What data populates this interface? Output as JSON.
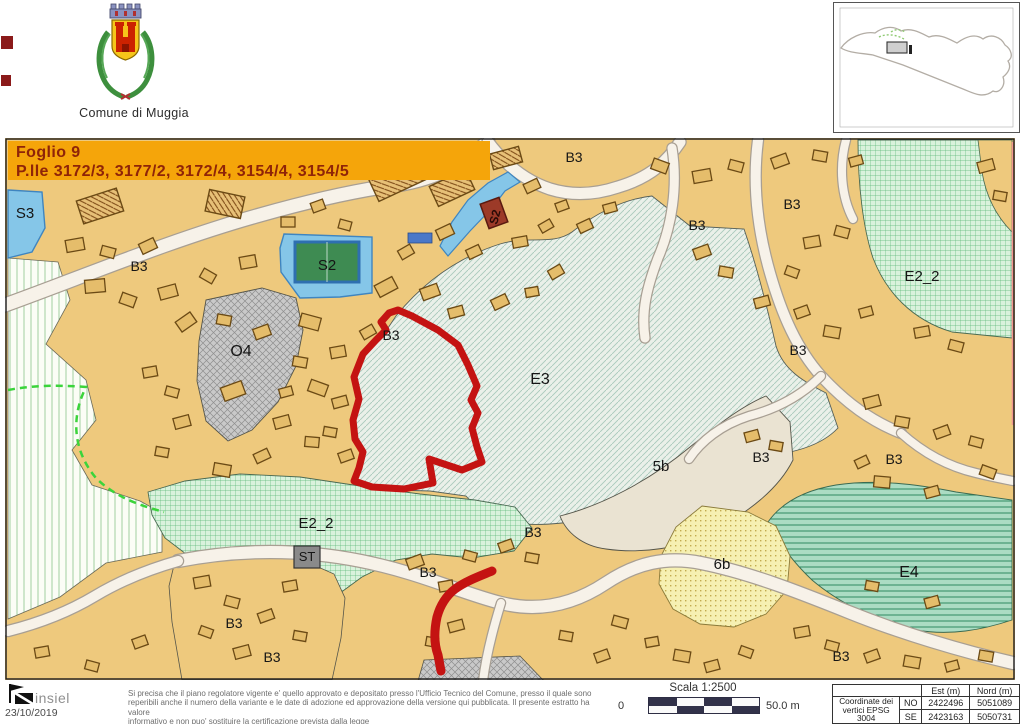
{
  "header": {
    "municipality": "Comune di Muggia"
  },
  "map": {
    "title_line1": "Foglio 9",
    "title_line2": "P.lle 3172/3, 3177/2, 3172/4, 3154/4, 3154/5",
    "building_label": "S2",
    "labels": [
      {
        "text": "S3",
        "x": 25,
        "y": 218,
        "size": 15
      },
      {
        "text": "B3",
        "x": 139,
        "y": 271,
        "size": 14
      },
      {
        "text": "S2",
        "x": 327,
        "y": 270,
        "size": 15
      },
      {
        "text": "B3",
        "x": 574,
        "y": 162,
        "size": 14
      },
      {
        "text": "B3",
        "x": 697,
        "y": 230,
        "size": 14
      },
      {
        "text": "B3",
        "x": 792,
        "y": 209,
        "size": 14
      },
      {
        "text": "E2_2",
        "x": 922,
        "y": 281,
        "size": 15
      },
      {
        "text": "B3",
        "x": 391,
        "y": 340,
        "size": 14
      },
      {
        "text": "O4",
        "x": 241,
        "y": 356,
        "size": 16
      },
      {
        "text": "E3",
        "x": 540,
        "y": 384,
        "size": 16
      },
      {
        "text": "B3",
        "x": 798,
        "y": 355,
        "size": 14
      },
      {
        "text": "B3",
        "x": 761,
        "y": 462,
        "size": 14
      },
      {
        "text": "5b",
        "x": 661,
        "y": 471,
        "size": 15
      },
      {
        "text": "B3",
        "x": 894,
        "y": 464,
        "size": 14
      },
      {
        "text": "E2_2",
        "x": 316,
        "y": 528,
        "size": 15
      },
      {
        "text": "ST",
        "x": 307,
        "y": 561,
        "size": 13
      },
      {
        "text": "B3",
        "x": 533,
        "y": 537,
        "size": 14
      },
      {
        "text": "B3",
        "x": 428,
        "y": 577,
        "size": 14
      },
      {
        "text": "6b",
        "x": 722,
        "y": 569,
        "size": 15
      },
      {
        "text": "E4",
        "x": 909,
        "y": 577,
        "size": 16
      },
      {
        "text": "B3",
        "x": 234,
        "y": 628,
        "size": 14
      },
      {
        "text": "B3",
        "x": 272,
        "y": 662,
        "size": 14
      },
      {
        "text": "B3",
        "x": 841,
        "y": 661,
        "size": 14
      }
    ]
  },
  "footer": {
    "logo_text": "insiel",
    "date": "23/10/2019",
    "disclaimer_lines": [
      "Si precisa che il piano regolatore vigente e' quello approvato e depositato presso l'Ufficio Tecnico del Comune, presso il quale sono",
      "reperibili anche il numero della variante e le date di adozione ed approvazione della versione qui pubblicata. Il presente estratto ha valore",
      "informativo e non puo' sostituire la certificazione prevista dalla legge"
    ],
    "scale": {
      "label": "Scala 1:2500",
      "zero": "0",
      "max": "50.0 m"
    },
    "coordinates_table": {
      "row_label_line1": "Coordinate dei",
      "row_label_line2": "vertici EPSG 3004",
      "col_est": "Est (m)",
      "col_nord": "Nord (m)",
      "rows": [
        {
          "corner": "NO",
          "est": "2422496",
          "nord": "5051089"
        },
        {
          "corner": "SE",
          "est": "2423163",
          "nord": "5050731"
        }
      ]
    }
  },
  "colors": {
    "map_background": "#eec97d",
    "title_background": "#f5a50a",
    "title_text": "#8f2408",
    "parcel_highlight": "#c41312",
    "zone_blue": "#85c6e8",
    "zone_gray": "#c9c9c9",
    "accent_green_dash": "#3bd43b"
  }
}
